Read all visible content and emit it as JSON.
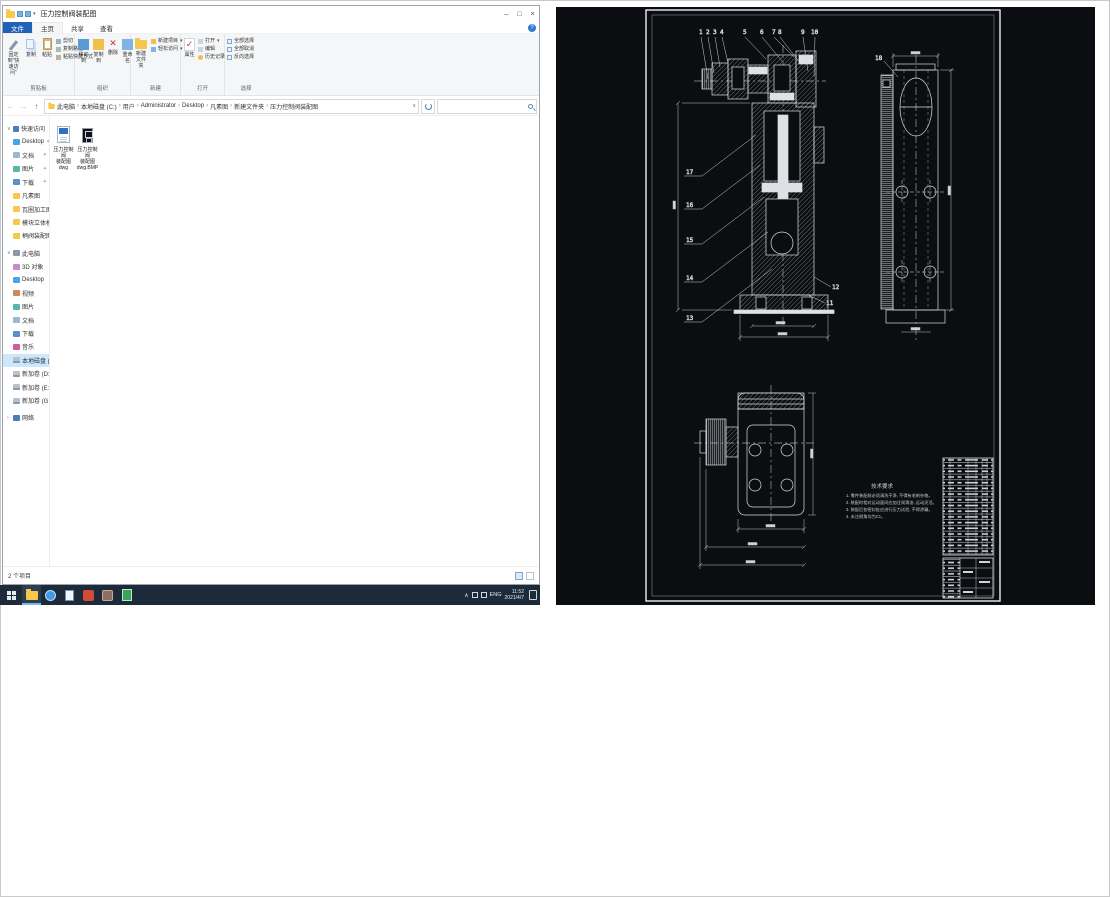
{
  "window": {
    "title": "压力控制阀装配图"
  },
  "titlebar": {
    "minimize": "–",
    "maximize": "□",
    "close": "×"
  },
  "tabs": {
    "file": "文件",
    "home": "主页",
    "share": "共享",
    "view": "查看",
    "help": "?"
  },
  "ribbon": {
    "clipboard": {
      "label": "剪贴板",
      "pin": "固定到\"快速访问\"",
      "copy": "复制",
      "paste": "粘贴",
      "cut": "剪切",
      "copy_path": "复制路径",
      "paste_shortcut": "粘贴快捷方式"
    },
    "organize": {
      "label": "组织",
      "move": "移动到",
      "copy_to": "复制到",
      "del": "删除",
      "rename": "重命名"
    },
    "newgrp": {
      "label": "新建",
      "new_folder": "新建文件夹",
      "new_item": "新建项目",
      "easy_access": "轻松访问"
    },
    "open": {
      "label": "打开",
      "properties": "属性",
      "open": "打开",
      "edit": "编辑",
      "history": "历史记录"
    },
    "select": {
      "label": "选择",
      "select_all": "全部选择",
      "select_none": "全部取消",
      "invert": "反向选择"
    }
  },
  "address": {
    "crumbs": [
      "此电脑",
      "本地磁盘 (C:)",
      "用户",
      "Administrator",
      "Desktop",
      "凡素图",
      "新建文件夹",
      "压力控制阀装配图"
    ]
  },
  "sidebar": {
    "quick_access": {
      "label": "快速访问",
      "items": [
        "Desktop",
        "文档",
        "图片",
        "下载",
        "凡素图",
        "瓦圈加工图",
        "模块立体模图",
        "柄阀装配图"
      ]
    },
    "this_pc": {
      "label": "此电脑",
      "items": [
        "3D 对象",
        "Desktop",
        "视频",
        "图片",
        "文档",
        "下载",
        "音乐",
        "本地磁盘 (C:)",
        "新加卷 (D:)",
        "新加卷 (E:)",
        "新加卷 (G:)"
      ]
    },
    "network": {
      "label": "网络"
    }
  },
  "files": [
    {
      "lines": [
        "压力控制阀",
        "装配图",
        "dwg"
      ]
    },
    {
      "lines": [
        "压力控制阀",
        "装配图",
        "dwg.BMP"
      ]
    }
  ],
  "status": {
    "count": "2 个项目"
  },
  "tray": {
    "lang": "ENG",
    "time": "11:52",
    "date": "2021/4/7"
  },
  "cad": {
    "callouts_top": [
      "1",
      "2",
      "3",
      "4",
      "5",
      "6",
      "7",
      "8",
      "9",
      "10"
    ],
    "callouts_left": [
      "17",
      "16",
      "15",
      "14",
      "13"
    ],
    "callouts_mid": [
      "12",
      "11"
    ],
    "callout_extra": "18",
    "notes_title": "技术要求",
    "notes": [
      "1. 零件装配前必须清洗干净, 不得有毛刺杂物。",
      "2. 装配时相对运动面间应加注润滑油, 运动灵活。",
      "3. 装配后各密封处应进行压力试验, 不得渗漏。",
      "4. 未注倒角均为C1。"
    ]
  }
}
